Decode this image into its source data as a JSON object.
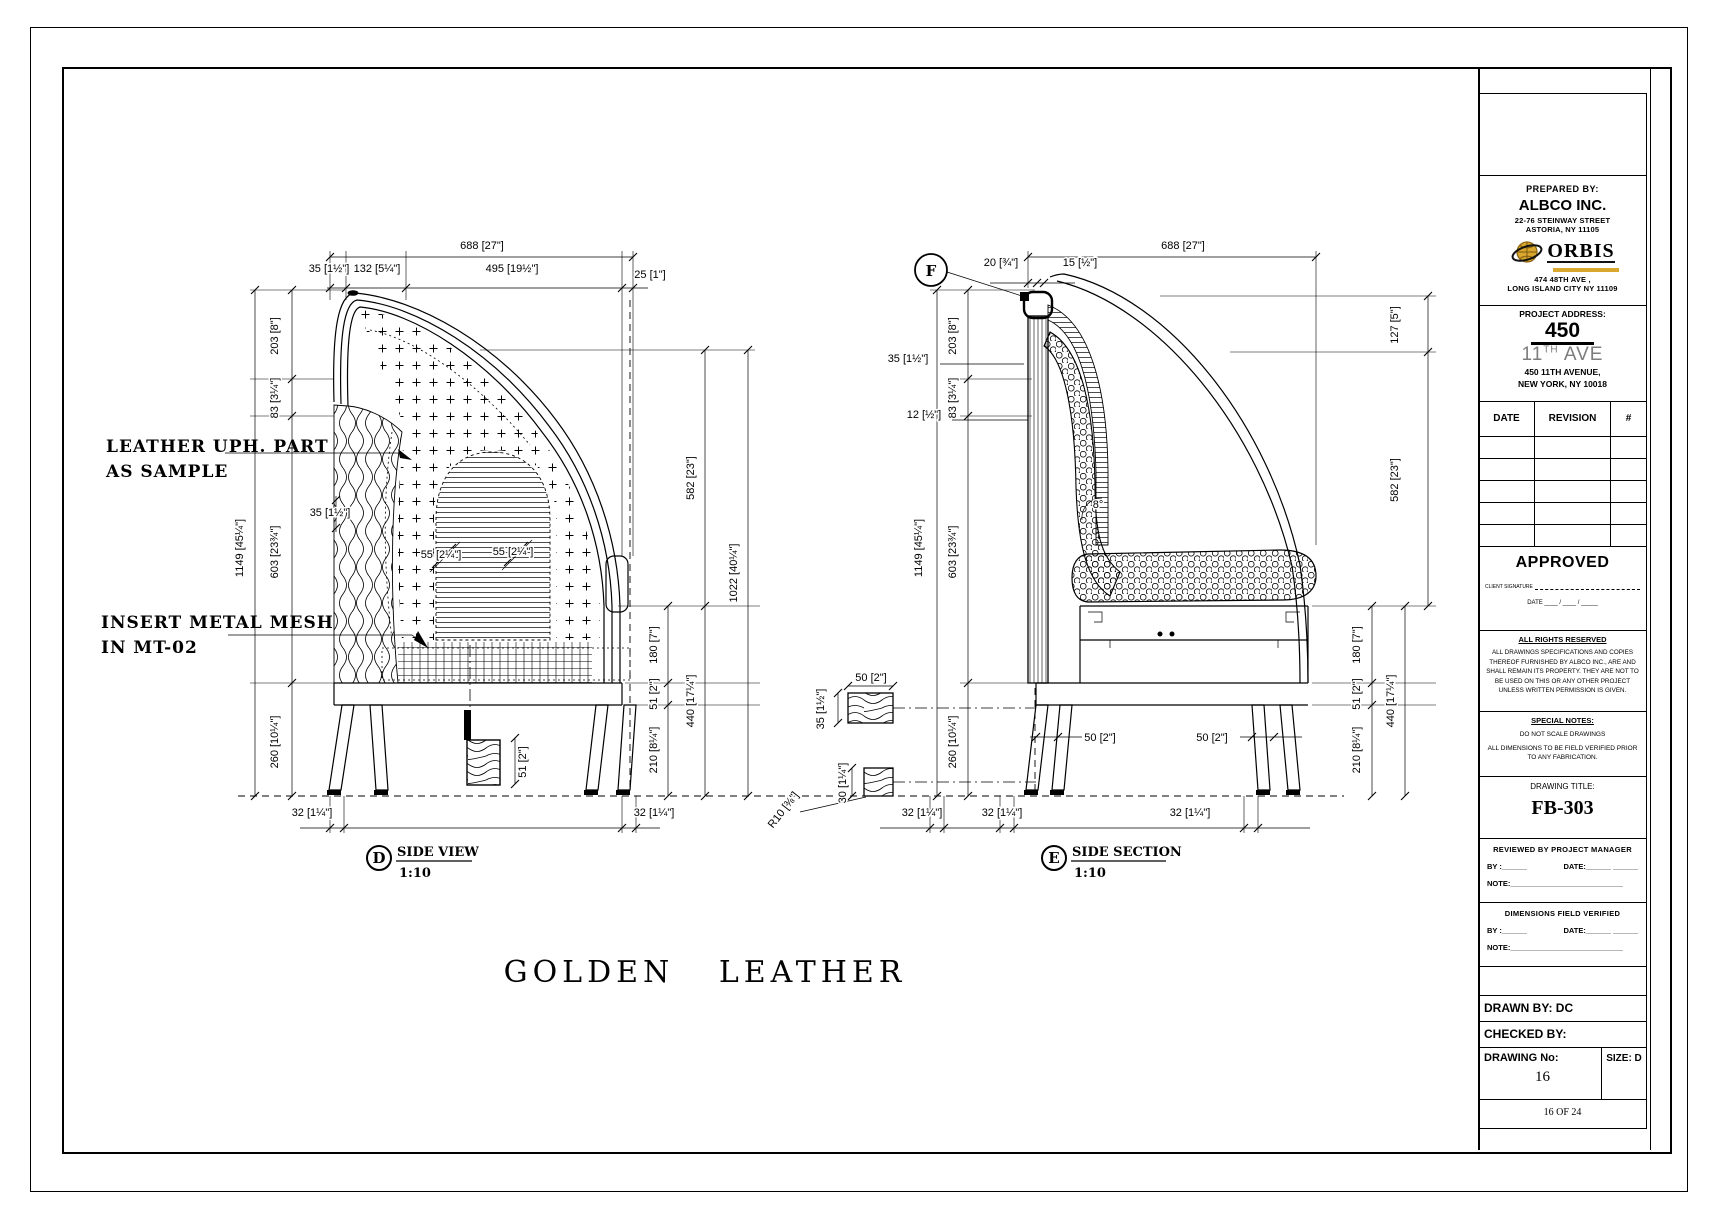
{
  "drawing": {
    "main_title": "GOLDEN LEATHER",
    "annotations": {
      "leather_1": "LEATHER UPH. PART",
      "leather_2": "AS SAMPLE",
      "mesh_1": "INSERT METAL MESH",
      "mesh_2": "IN MT-02"
    },
    "views": {
      "d": {
        "letter": "D",
        "name": "SIDE VIEW",
        "scale": "1:10"
      },
      "e": {
        "letter": "E",
        "name": "SIDE SECTION",
        "scale": "1:10"
      },
      "f_marker": "F"
    },
    "dims_side_view": [
      {
        "t": "688 [27\"]",
        "x": 482,
        "y": 249
      },
      {
        "t": "35 [1½\"]",
        "x": 329,
        "y": 272
      },
      {
        "t": "132 [5¼\"]",
        "x": 377,
        "y": 272
      },
      {
        "t": "495 [19½\"]",
        "x": 512,
        "y": 272
      },
      {
        "t": "25 [1\"]",
        "x": 650,
        "y": 278
      },
      {
        "t": "203 [8\"]",
        "x": 278,
        "y": 336,
        "r": -90
      },
      {
        "t": "83 [3¼\"]",
        "x": 278,
        "y": 398,
        "r": -90
      },
      {
        "t": "1149 [45¼\"]",
        "x": 243,
        "y": 548,
        "r": -90
      },
      {
        "t": "603 [23¾\"]",
        "x": 278,
        "y": 552,
        "r": -90
      },
      {
        "t": "260 [10¼\"]",
        "x": 278,
        "y": 742,
        "r": -90
      },
      {
        "t": "35 [1½\"]",
        "x": 330,
        "y": 516
      },
      {
        "t": "55 [2¼\"]",
        "x": 441,
        "y": 558
      },
      {
        "t": "55 [2¼\"]",
        "x": 513,
        "y": 555
      },
      {
        "t": "51 [2\"]",
        "x": 526,
        "y": 762,
        "r": -90
      },
      {
        "t": "32 [1¼\"]",
        "x": 312,
        "y": 816
      },
      {
        "t": "32 [1¼\"]",
        "x": 654,
        "y": 816
      },
      {
        "t": "582 [23\"]",
        "x": 694,
        "y": 478,
        "r": -90
      },
      {
        "t": "440 [17¼\"]",
        "x": 694,
        "y": 701,
        "r": -90
      },
      {
        "t": "1022 [40¼\"]",
        "x": 737,
        "y": 573,
        "r": -90
      },
      {
        "t": "180 [7\"]",
        "x": 657,
        "y": 645,
        "r": -90
      },
      {
        "t": "51 [2\"]",
        "x": 657,
        "y": 694,
        "r": -90
      },
      {
        "t": "210 [8¼\"]",
        "x": 657,
        "y": 750,
        "r": -90
      }
    ],
    "dims_side_section": [
      {
        "t": "688 [27\"]",
        "x": 1183,
        "y": 249
      },
      {
        "t": "20 [¾\"]",
        "x": 1001,
        "y": 266
      },
      {
        "t": "15 [½\"]",
        "x": 1080,
        "y": 266
      },
      {
        "t": "35 [1½\"]",
        "x": 908,
        "y": 362
      },
      {
        "t": "12 [½\"]",
        "x": 924,
        "y": 418
      },
      {
        "t": "203 [8\"]",
        "x": 956,
        "y": 336,
        "r": -90
      },
      {
        "t": "83 [3¼\"]",
        "x": 956,
        "y": 398,
        "r": -90
      },
      {
        "t": "1149 [45¼\"]",
        "x": 922,
        "y": 548,
        "r": -90
      },
      {
        "t": "603 [23¾\"]",
        "x": 956,
        "y": 552,
        "r": -90
      },
      {
        "t": "260 [10¼\"]",
        "x": 956,
        "y": 742,
        "r": -90
      },
      {
        "t": "50 [2\"]",
        "x": 871,
        "y": 681
      },
      {
        "t": "35 [1½\"]",
        "x": 824,
        "y": 709,
        "r": -90
      },
      {
        "t": "30 [1¼\"]",
        "x": 846,
        "y": 783,
        "r": -90
      },
      {
        "t": "R10 [⅜\"]",
        "x": 786,
        "y": 812,
        "r": -52
      },
      {
        "t": "32 [1¼\"]",
        "x": 922,
        "y": 816
      },
      {
        "t": "32 [1¼\"]",
        "x": 1002,
        "y": 816
      },
      {
        "t": "32 [1¼\"]",
        "x": 1190,
        "y": 816
      },
      {
        "t": "50 [2\"]",
        "x": 1100,
        "y": 741
      },
      {
        "t": "50 [2\"]",
        "x": 1212,
        "y": 741
      },
      {
        "t": "8°",
        "x": 1098,
        "y": 508
      },
      {
        "t": "127 [5\"]",
        "x": 1398,
        "y": 325,
        "r": -90
      },
      {
        "t": "582 [23\"]",
        "x": 1398,
        "y": 480,
        "r": -90
      },
      {
        "t": "440 [17¼\"]",
        "x": 1394,
        "y": 701,
        "r": -90
      },
      {
        "t": "180 [7\"]",
        "x": 1360,
        "y": 645,
        "r": -90
      },
      {
        "t": "51 [2\"]",
        "x": 1360,
        "y": 694,
        "r": -90
      },
      {
        "t": "210 [8¼\"]",
        "x": 1360,
        "y": 750,
        "r": -90
      }
    ]
  },
  "title_block": {
    "prepared_by_label": "PREPARED BY:",
    "company": "ALBCO INC.",
    "company_addr1": "22-76 STEINWAY STREET",
    "company_addr2": "ASTORIA, NY 11105",
    "orbis": "ORBIS",
    "orbis_addr1": "474 48TH AVE ,",
    "orbis_addr2": "LONG ISLAND CITY NY 11109",
    "project_address_label": "PROJECT ADDRESS:",
    "project_number": "450",
    "project_street_pre": "11",
    "project_street_sup": "TH",
    "project_street_post": " AVE",
    "project_addr1": "450 11TH AVENUE,",
    "project_addr2": "NEW YORK, NY 10018",
    "rev_headers": [
      "DATE",
      "REVISION",
      "#"
    ],
    "approved_label": "APPROVED",
    "client_sig_label": "CLIENT SIGNATURE",
    "date_line": "DATE ____ / ____ / _____",
    "rights_title": "ALL RIGHTS RESERVED",
    "rights_body": "ALL DRAWINGS SPECIFICATIONS AND COPIES THEREOF FURNISHED BY ALBCO INC., ARE AND SHALL REMAIN ITS PROPERTY. THEY ARE NOT TO BE USED ON THIS OR ANY OTHER PROJECT UNLESS WRITTEN PERMISSION IS GIVEN.",
    "special_title": "SPECIAL NOTES:",
    "special_1": "DO NOT SCALE DRAWINGS",
    "special_2": "ALL DIMENSIONS TO BE FIELD VERIFIED PRIOR TO ANY FABRICATION.",
    "drawing_title_label": "DRAWING TITLE:",
    "drawing_title": "FB-303",
    "reviewed_label": "REVIEWED BY PROJECT MANAGER",
    "by_line": "BY :______",
    "date_line2": "DATE:______ ______",
    "note_line": "NOTE:___________________________",
    "dims_verified_label": "DIMENSIONS FIELD VERIFIED",
    "drawn_by": "DRAWN BY: DC",
    "checked_by": "CHECKED BY:",
    "drawing_no_label": "DRAWING No:",
    "size_label": "SIZE: D",
    "drawing_no": "16",
    "page_info": "16  OF 24"
  }
}
